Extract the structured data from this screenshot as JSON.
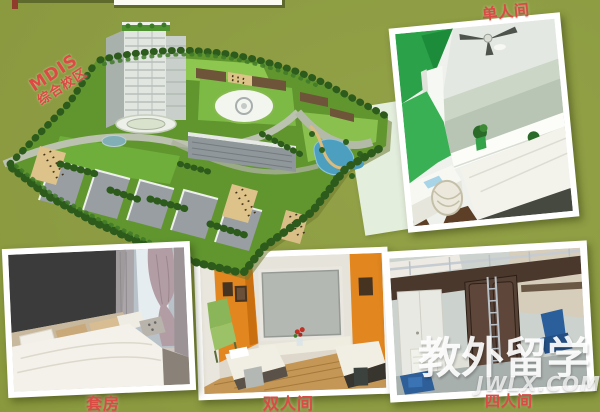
{
  "poster": {
    "campus": {
      "label_en": "MDIS",
      "label_zh": "综合校区"
    },
    "rooms": {
      "single": "单人间",
      "suite": "套房",
      "double": "双人间",
      "quad": "四人间"
    },
    "watermark": {
      "brand": "教外留学",
      "site": "JWLX.COM"
    },
    "colors": {
      "background": "#8c9b41",
      "label_red": "#d94c44",
      "photo_frame": "#ffffff",
      "campus_land_green": "#61962f",
      "watermark_white": "#ffffff"
    }
  }
}
